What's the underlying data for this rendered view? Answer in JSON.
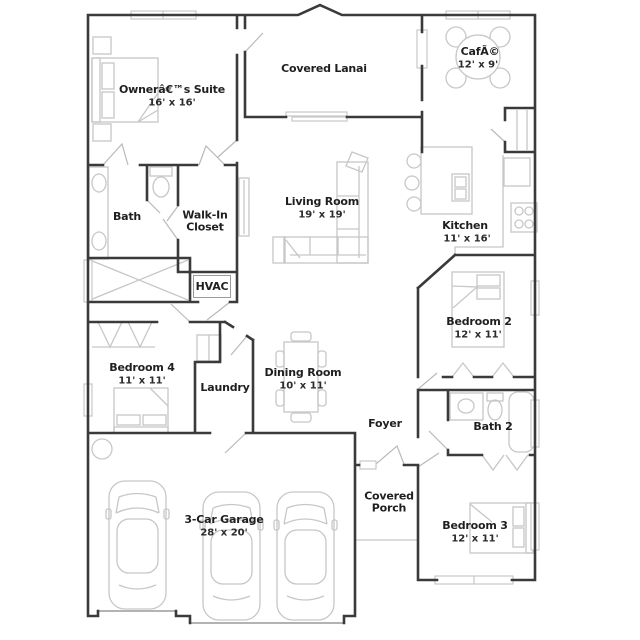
{
  "plan_title": "Single-story home floor plan",
  "colors": {
    "wall": "#3a3a3a",
    "furniture": "#c7c7c7",
    "door": "#b9b9b9",
    "garage_door": "#9a9a9a",
    "text": "#1f1f1f"
  },
  "rooms": [
    {
      "id": "owners-suite",
      "name": "Ownerâ€™s Suite",
      "dims": "16' x 16'"
    },
    {
      "id": "covered-lanai",
      "name": "Covered Lanai",
      "dims": ""
    },
    {
      "id": "cafe",
      "name": "CafÃ©",
      "dims": "12' x 9'"
    },
    {
      "id": "bath",
      "name": "Bath",
      "dims": ""
    },
    {
      "id": "walk-in-closet",
      "name": "Walk-In Closet",
      "dims": ""
    },
    {
      "id": "living-room",
      "name": "Living Room",
      "dims": "19' x 19'"
    },
    {
      "id": "kitchen",
      "name": "Kitchen",
      "dims": "11' x 16'"
    },
    {
      "id": "hvac",
      "name": "HVAC",
      "dims": ""
    },
    {
      "id": "bedroom-2",
      "name": "Bedroom 2",
      "dims": "12' x 11'"
    },
    {
      "id": "bedroom-4",
      "name": "Bedroom 4",
      "dims": "11' x 11'"
    },
    {
      "id": "laundry",
      "name": "Laundry",
      "dims": ""
    },
    {
      "id": "dining-room",
      "name": "Dining Room",
      "dims": "10' x 11'"
    },
    {
      "id": "foyer",
      "name": "Foyer",
      "dims": ""
    },
    {
      "id": "bath-2",
      "name": "Bath 2",
      "dims": ""
    },
    {
      "id": "covered-porch",
      "name": "Covered Porch",
      "dims": ""
    },
    {
      "id": "bedroom-3",
      "name": "Bedroom 3",
      "dims": "12' x 11'"
    },
    {
      "id": "garage",
      "name": "3-Car Garage",
      "dims": "28' x 20'"
    }
  ]
}
